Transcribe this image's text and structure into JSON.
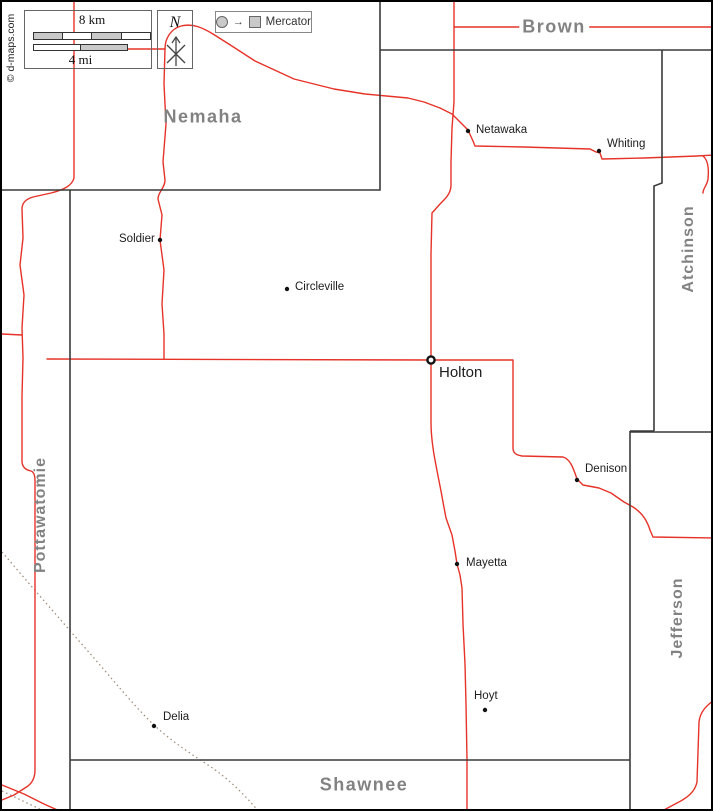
{
  "attribution": "© d-maps.com",
  "scale": {
    "km": "8 km",
    "mi": "4 mi"
  },
  "compass": {
    "north": "N"
  },
  "projection": {
    "arrow": "→",
    "label": "Mercator"
  },
  "counties": {
    "nemaha": "Nemaha",
    "brown": "Brown",
    "atchinson": "Atchinson",
    "jefferson": "Jefferson",
    "shawnee": "Shawnee",
    "pottawatomie": "Pottawatomie"
  },
  "towns": {
    "netawaka": "Netawaka",
    "whiting": "Whiting",
    "soldier": "Soldier",
    "circleville": "Circleville",
    "holton": "Holton",
    "denison": "Denison",
    "mayetta": "Mayetta",
    "hoyt": "Hoyt",
    "delia": "Delia"
  },
  "colors": {
    "road": "#e63328",
    "boundary": "#3a3a3a",
    "railroad": "#9b8876",
    "county_label": "#828282",
    "town_label": "#1c1c1c"
  }
}
